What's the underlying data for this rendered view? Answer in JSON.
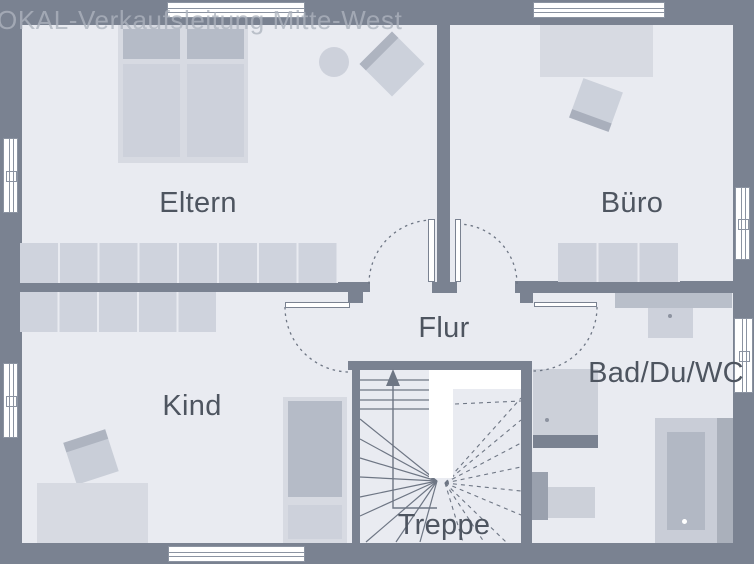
{
  "watermark": {
    "text": "OKAL-Verkaufsleitung Mitte-West"
  },
  "rooms": {
    "eltern": {
      "label": "Eltern"
    },
    "buero": {
      "label": "Büro"
    },
    "kind": {
      "label": "Kind"
    },
    "flur": {
      "label": "Flur"
    },
    "bad": {
      "label": "Bad/Du/WC"
    },
    "treppe": {
      "label": "Treppe"
    }
  },
  "colors": {
    "wall": "#7a8291",
    "floor": "#e9ebf1",
    "furniture_light": "#d7dae2",
    "furniture_mid": "#cdd1db",
    "furniture_dark": "#b5bbc7",
    "label_text": "#4e5560",
    "plan_lines": "#6e7684",
    "watermark_text": "#adb3be",
    "window_fill": "#ffffff"
  }
}
